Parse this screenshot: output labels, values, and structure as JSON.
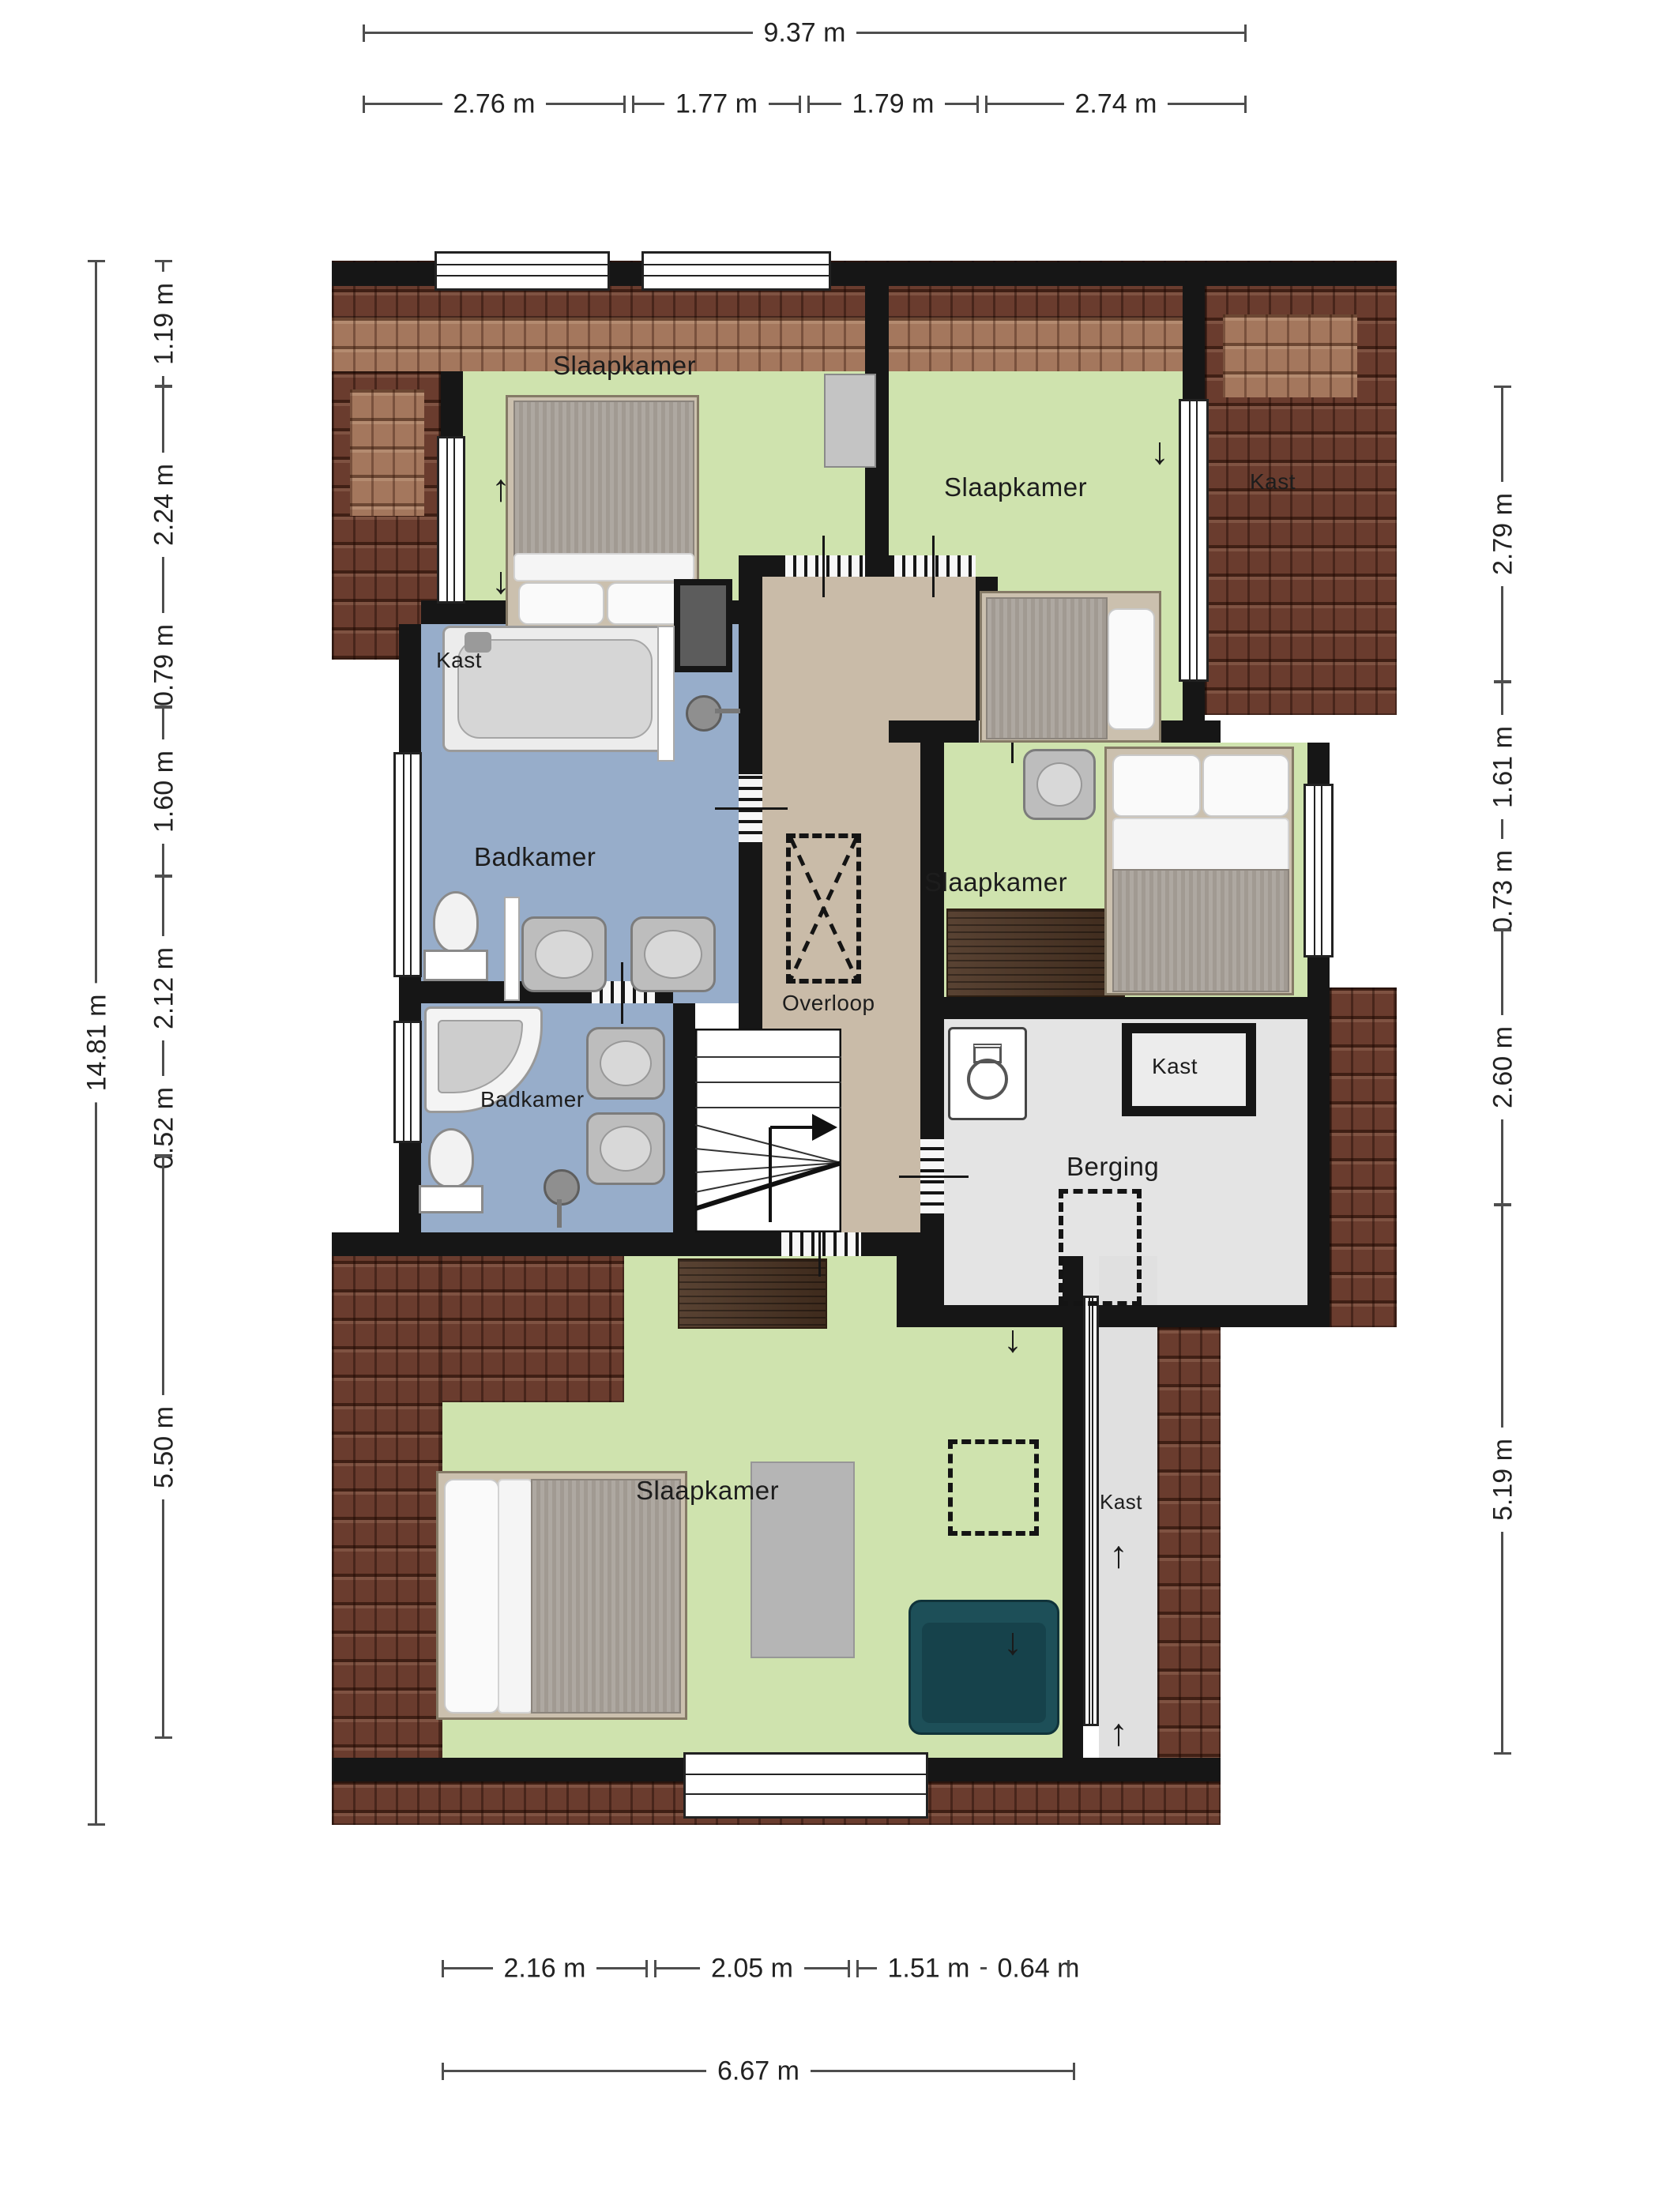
{
  "dims": {
    "top_overall": "9.37 m",
    "top_segments": [
      "2.76 m",
      "1.77 m",
      "1.79 m",
      "2.74 m"
    ],
    "left_overall": "14.81 m",
    "left_segments": [
      "1.19 m",
      "2.24 m",
      "0.79 m",
      "1.60 m",
      "2.12 m",
      "0.52 m",
      "5.50 m"
    ],
    "right_segments": [
      "2.79 m",
      "1.61 m",
      "0.73 m",
      "2.60 m",
      "5.19 m"
    ],
    "bottom_segments": [
      "2.16 m",
      "2.05 m",
      "1.51 m",
      "0.64 m"
    ],
    "bottom_overall": "6.67 m"
  },
  "labels": {
    "bedroom": "Slaapkamer",
    "bathroom": "Badkamer",
    "landing": "Overloop",
    "storage": "Berging",
    "closet": "Kast"
  },
  "symbols": {
    "arrow_up": "↑",
    "arrow_down": "↓"
  },
  "colors": {
    "bedroom_floor": "#cfe3ae",
    "bathroom_floor": "#97adca",
    "hall_floor": "#c9bba8",
    "storage_floor": "#e4e4e4",
    "roof_dark": "#6a3c2e",
    "roof_light": "#a4775d",
    "wall": "#161616",
    "wood": "#4c3423",
    "armchair": "#1d4f58"
  }
}
